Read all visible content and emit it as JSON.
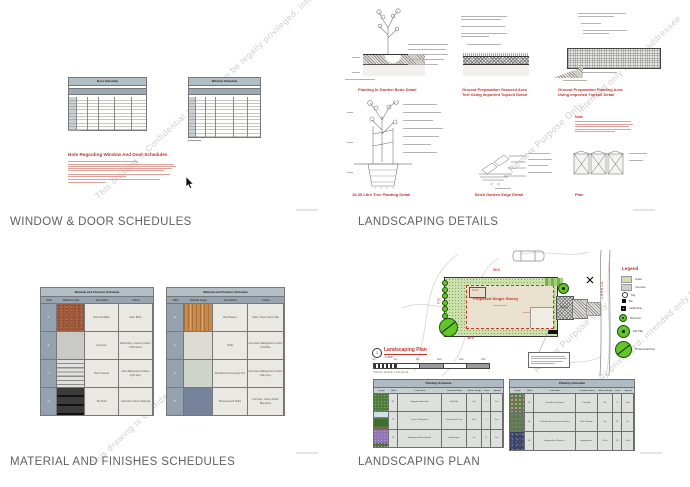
{
  "watermarks": {
    "color": "#c8c8c8",
    "w1": "This drawing is Confidential and may also be legally privileged, intended only for the addressee",
    "w2a": "Review Purpose Only",
    "w2b": "intended only for the addressee",
    "w3a": "Review Purpose Only",
    "w3b": "may also be legally privileged, intended only for the addressee",
    "w4": "This drawing is Confidential"
  },
  "colors": {
    "accent_red": "#c2342c",
    "table_header": "#b2bfc7",
    "caption_grey": "#606060"
  },
  "sheet1": {
    "caption": "WINDOW & DOOR SCHEDULES",
    "door_schedule_title": "Door Schedule",
    "window_schedule_title": "Window Schedule",
    "note_title": "Note Regarding Window And Door Schedules"
  },
  "sheet2": {
    "caption": "LANDSCAPING DETAILS",
    "caption1": "Planting In Garden Beds Detail",
    "caption2a": "Ground Preparation Grassed Area",
    "caption2b": "Turf Using Imported Topsoil Detail",
    "caption3a": "Ground Preparation Planting Area",
    "caption3b": "Using Imported Topsoil Detail",
    "caption4": "15-35 Litre Tree Planting Detail",
    "caption5": "Brick Garden Edge Detail",
    "caption6": "Plan",
    "note_title": "Note"
  },
  "sheet3": {
    "caption": "MATERIAL AND FINISHES SCHEDULES",
    "table_title": "Material and Finishes Schedule",
    "columns": {
      "mark": "Mark",
      "image": "Material Image",
      "description": "Description",
      "colour": "Colour"
    },
    "left": {
      "rows": [
        {
          "mark": "A",
          "description": "External Walls",
          "colour": "Face Brick"
        },
        {
          "mark": "B",
          "description": "Concrete",
          "colour": "Boral Clay / Cement Colour CSR Stone"
        },
        {
          "mark": "C",
          "description": "Roof / Fascia",
          "colour": "Steel Background Colour Light Grey"
        },
        {
          "mark": "D",
          "description": "Tile Roof",
          "colour": "Concrete Colour Charcoal"
        }
      ]
    },
    "right": {
      "rows": [
        {
          "mark": "E",
          "description": "Roof Beams",
          "colour": "Stain, Clear Colour Oak"
        },
        {
          "mark": "F",
          "description": "Trellis",
          "colour": "Aluminium Background Colour Off White"
        },
        {
          "mark": "G",
          "description": "Windows And Framing Trim",
          "colour": "Aluminium Background Colour Pale Grey"
        },
        {
          "mark": "H",
          "description": "Driveway And Paths",
          "colour": "Concrete, Colour Finish Bluestone"
        }
      ]
    }
  },
  "sheet4": {
    "caption": "LANDSCAPING PLAN",
    "plan_ref": "1",
    "plan_title": "Landscaping Plan",
    "plan_scale": "1:200",
    "visual_scale": "VISUAL SCALE 1:200 @ A3",
    "scale_ticks": [
      "0m",
      "4m",
      "8m",
      "12m",
      "16m",
      "20m"
    ],
    "building_label": "Proposed Single Storey",
    "porch_label": "Porch",
    "garage_label": "Garage",
    "street_label": "STREET",
    "dim_top": "30.0",
    "dim_bottom": "30.0",
    "dim_left": "37.0",
    "legend": {
      "title": "Legend",
      "items": [
        {
          "label": "Grass"
        },
        {
          "label": "Concrete"
        },
        {
          "label": "Tap"
        },
        {
          "label": "Bin"
        },
        {
          "label": "Clothesline"
        },
        {
          "label": "Viburnum"
        },
        {
          "label": "Lilly Pilly"
        },
        {
          "label": "Ornamental Pear"
        }
      ]
    },
    "planting_title": "Planting Schedule",
    "planting_columns": [
      "Image",
      "Mark",
      "Latin Name",
      "Common Name",
      "Mature Height",
      "Count",
      "Spread"
    ],
    "planting_left": {
      "rows": [
        {
          "mark": "S1",
          "latin": "Syzygium Australe",
          "common": "Lilly Pilly",
          "height": "4m",
          "count": "7",
          "spread": "2m"
        },
        {
          "mark": "T1",
          "latin": "Pyrus Calleryana",
          "common": "Ornamental Pear",
          "height": "8m",
          "count": "1",
          "spread": "5m"
        },
        {
          "mark": "S2",
          "latin": "Hydrangea Macrophylla",
          "common": "Hydrangea",
          "height": "1m",
          "count": "6",
          "spread": "1m"
        }
      ]
    },
    "planting_right": {
      "rows": [
        {
          "mark": "S3",
          "latin": "Camellia Sasanqua",
          "common": "Camellia",
          "height": "3m",
          "count": "5",
          "spread": "1.5m"
        },
        {
          "mark": "S4",
          "latin": "Trachelospermum Jasminoides",
          "common": "Star Jasmine",
          "height": "3m",
          "count": "12",
          "spread": "2m"
        },
        {
          "mark": "S5",
          "latin": "Agapanthus Praecox",
          "common": "Agapanthus",
          "height": "0.6m",
          "count": "20",
          "spread": "0.5m"
        }
      ]
    }
  }
}
